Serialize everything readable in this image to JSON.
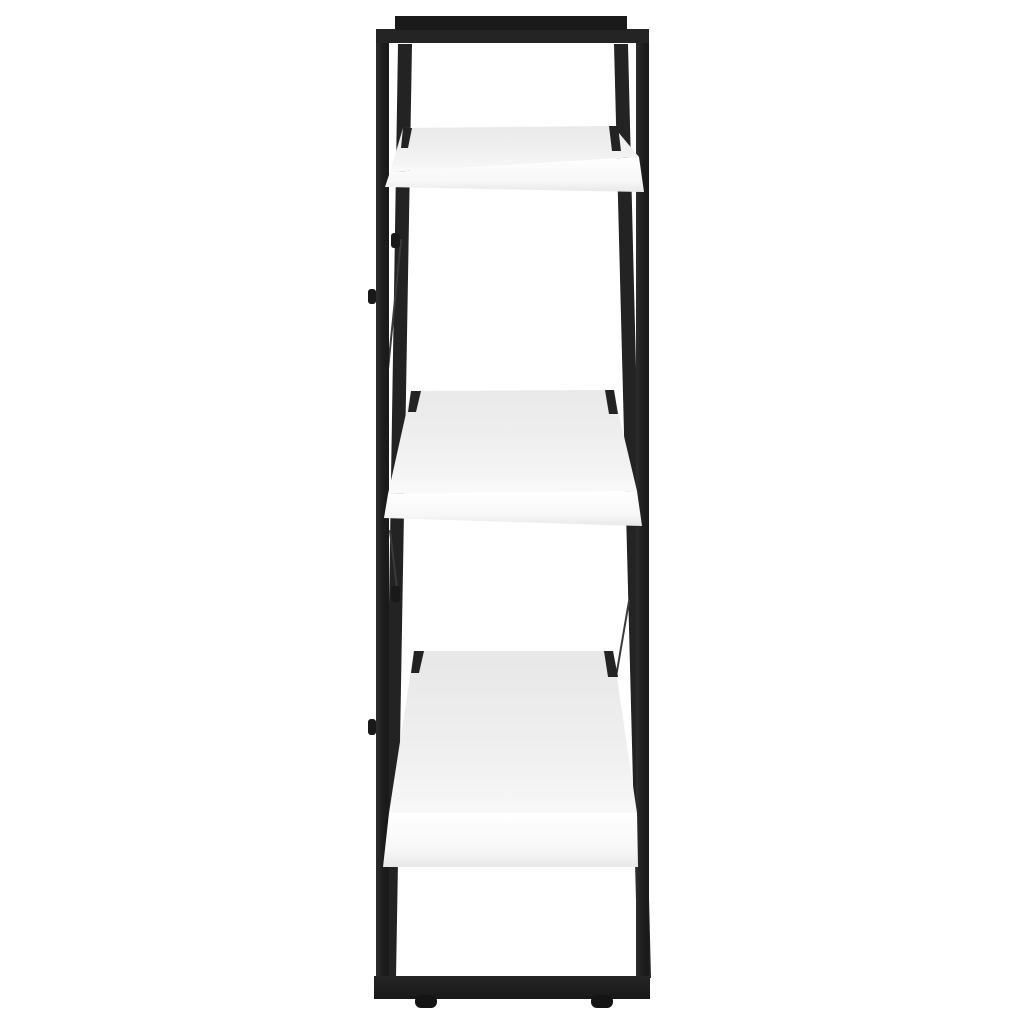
{
  "scene": {
    "description": "Product photograph: side view of a 3-tier bookcase with a black square-tube metal frame and three white board shelves, isolated on a plain white background",
    "width": 1024,
    "height": 1024,
    "background_color": "#ffffff"
  },
  "palette": {
    "frame_black": "#202020",
    "frame_black_soft": "#232323",
    "frame_black_deep": "#191919",
    "cap_black": "#1a1a1a",
    "foot_black": "#141414",
    "cable_gray": "#3a3a3a",
    "shelf_top_gray": "#e9e9e9",
    "shelf_front_white": "#ffffff",
    "shelf_front_shade": "#ededed"
  },
  "parts": [
    {
      "name": "back-post-left",
      "shape": "polygon",
      "points": "398,44 412,44 396,978 383,978",
      "fill": "#232323"
    },
    {
      "name": "back-post-right",
      "shape": "polygon",
      "points": "614,44 628,44 651,978 638,978",
      "fill": "#232323"
    },
    {
      "name": "cross-brace-cable-upper",
      "shape": "line",
      "x1": 401,
      "y1": 240,
      "x2": 387,
      "y2": 379,
      "stroke": "#3a3a3a",
      "strokeWidth": 2
    },
    {
      "name": "cross-brace-cable-middle",
      "shape": "line",
      "x1": 390,
      "y1": 531,
      "x2": 398,
      "y2": 597,
      "stroke": "#3a3a3a",
      "strokeWidth": 2
    },
    {
      "name": "cross-brace-cable-lower",
      "shape": "line",
      "x1": 629,
      "y1": 601,
      "x2": 616,
      "y2": 677,
      "stroke": "#3a3a3a",
      "strokeWidth": 2
    },
    {
      "name": "bolt-back-post-upper",
      "shape": "rect",
      "x": 391,
      "y": 233,
      "width": 9,
      "height": 15,
      "rx": 3,
      "fill": "#191919"
    },
    {
      "name": "bolt-back-post-lower",
      "shape": "rect",
      "x": 391,
      "y": 586,
      "width": 9,
      "height": 16,
      "rx": 3,
      "fill": "#191919"
    },
    {
      "name": "front-post-left",
      "shape": "rect",
      "x": 376,
      "y": 29,
      "width": 13,
      "height": 952,
      "fill": "url(#gradPost)"
    },
    {
      "name": "front-post-right",
      "shape": "rect",
      "x": 636,
      "y": 29,
      "width": 13,
      "height": 952,
      "fill": "url(#gradPost)"
    },
    {
      "name": "shelf-1-top-surface",
      "shape": "polygon",
      "points": "403,128 613,126 639,157 390,172",
      "fill": "url(#gradShelfTop)"
    },
    {
      "name": "shelf-1-front-edge",
      "shape": "polygon",
      "points": "390,172 639,157 644,192 385,187",
      "fill": "url(#gradShelfFront)"
    },
    {
      "name": "shelf-1-post-notch-left",
      "shape": "polygon",
      "points": "403,128 412,128 408,148 401,148",
      "fill": "#232323"
    },
    {
      "name": "shelf-1-post-notch-right",
      "shape": "polygon",
      "points": "609,126 618,126 621,151 612,151",
      "fill": "#232323"
    },
    {
      "name": "shelf-2-top-surface",
      "shape": "polygon",
      "points": "411,391 613,390 637,491 388,494",
      "fill": "url(#gradShelfTop)"
    },
    {
      "name": "shelf-2-front-edge",
      "shape": "polygon",
      "points": "388,494 637,491 642,526 384,518",
      "fill": "url(#gradShelfFront)"
    },
    {
      "name": "shelf-2-post-notch-left",
      "shape": "polygon",
      "points": "411,391 421,391 416,412 408,412",
      "fill": "#232323"
    },
    {
      "name": "shelf-2-post-notch-right",
      "shape": "polygon",
      "points": "605,390 614,390 618,414 609,414",
      "fill": "#232323"
    },
    {
      "name": "shelf-3-top-surface",
      "shape": "polygon",
      "points": "414,651 613,651 637,813 389,813",
      "fill": "url(#gradShelfTop3)"
    },
    {
      "name": "shelf-3-front-edge",
      "shape": "polygon",
      "points": "389,813 637,813 638,867 383,867",
      "fill": "url(#gradShelfFront)"
    },
    {
      "name": "shelf-3-post-notch-left",
      "shape": "polygon",
      "points": "414,651 424,651 419,673 411,673",
      "fill": "#232323"
    },
    {
      "name": "shelf-3-post-notch-right",
      "shape": "polygon",
      "points": "604,651 613,651 618,677 608,677",
      "fill": "#232323"
    },
    {
      "name": "frame-top-bar",
      "shape": "rect",
      "x": 376,
      "y": 29,
      "width": 273,
      "height": 14,
      "fill": "#242424"
    },
    {
      "name": "frame-top-cap",
      "shape": "rect",
      "x": 395,
      "y": 16,
      "width": 232,
      "height": 14,
      "fill": "#1a1a1a"
    },
    {
      "name": "frame-bottom-bar",
      "shape": "rect",
      "x": 374,
      "y": 976,
      "width": 276,
      "height": 23,
      "fill": "url(#gradBar)"
    },
    {
      "name": "foot-left",
      "shape": "rect",
      "x": 415,
      "y": 995,
      "width": 22,
      "height": 13,
      "rx": 6,
      "fill": "#141414"
    },
    {
      "name": "foot-right",
      "shape": "rect",
      "x": 591,
      "y": 995,
      "width": 22,
      "height": 13,
      "rx": 6,
      "fill": "#141414"
    },
    {
      "name": "bolt-front-post-upper",
      "shape": "rect",
      "x": 368,
      "y": 289,
      "width": 8,
      "height": 15,
      "rx": 3,
      "fill": "#191919"
    },
    {
      "name": "bolt-front-post-lower",
      "shape": "rect",
      "x": 368,
      "y": 719,
      "width": 8,
      "height": 16,
      "rx": 3,
      "fill": "#191919"
    }
  ]
}
